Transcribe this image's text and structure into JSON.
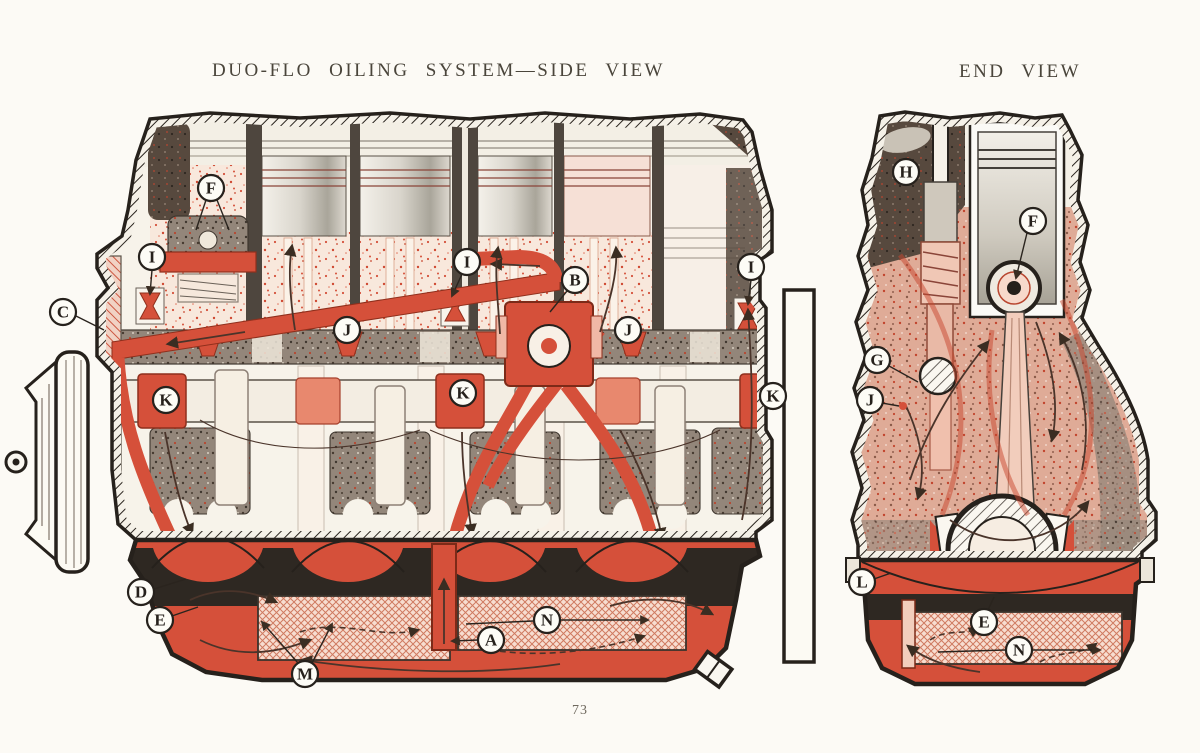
{
  "titles": {
    "side_view": "DUO-FLO OILING SYSTEM—SIDE VIEW",
    "end_view": "END VIEW"
  },
  "page_number": "73",
  "colors": {
    "paper": "#fcfaf5",
    "ink": "#26211c",
    "oil_red": "#d5503a",
    "salmon": "#e8886e",
    "pale_pink": "#f8e8dd",
    "speckle_gray": "#93867b",
    "piston_gray": "#c9c5ba"
  },
  "side_view": {
    "callouts": [
      {
        "letter": "F",
        "x": 211,
        "y": 188,
        "leaders": [
          {
            "d": "M206,200 L196,230"
          },
          {
            "d": "M217,200 L229,230"
          }
        ]
      },
      {
        "letter": "I",
        "x": 152,
        "y": 257,
        "leaders": [
          {
            "d": "M152,270 L150,294",
            "arrow": true
          }
        ]
      },
      {
        "letter": "C",
        "x": 63,
        "y": 312,
        "leaders": [
          {
            "d": "M76,316 L104,330"
          }
        ]
      },
      {
        "letter": "I",
        "x": 467,
        "y": 262,
        "leaders": [
          {
            "d": "M462,274 L452,296",
            "arrow": true
          }
        ]
      },
      {
        "letter": "B",
        "x": 575,
        "y": 280,
        "leaders": [
          {
            "d": "M567,291 L550,312"
          }
        ]
      },
      {
        "letter": "J",
        "x": 347,
        "y": 330,
        "leaders": []
      },
      {
        "letter": "J",
        "x": 628,
        "y": 330,
        "leaders": []
      },
      {
        "letter": "I",
        "x": 751,
        "y": 267,
        "leaders": [
          {
            "d": "M751,280 L748,304",
            "arrow": true
          }
        ]
      },
      {
        "letter": "K",
        "x": 166,
        "y": 400,
        "leaders": []
      },
      {
        "letter": "K",
        "x": 463,
        "y": 393,
        "leaders": []
      },
      {
        "letter": "K",
        "x": 773,
        "y": 396,
        "leaders": []
      },
      {
        "letter": "D",
        "x": 141,
        "y": 592,
        "leaders": [
          {
            "d": "M154,589 L186,579"
          }
        ]
      },
      {
        "letter": "E",
        "x": 160,
        "y": 620,
        "leaders": [
          {
            "d": "M172,616 L198,607"
          }
        ]
      },
      {
        "letter": "M",
        "x": 305,
        "y": 674,
        "leaders": [
          {
            "d": "M298,663 L262,622",
            "arrow": true
          },
          {
            "d": "M312,663 L332,624",
            "arrow": true
          }
        ]
      },
      {
        "letter": "A",
        "x": 491,
        "y": 640,
        "leaders": [
          {
            "d": "M478,640 L452,641",
            "arrow": true
          }
        ]
      },
      {
        "letter": "N",
        "x": 547,
        "y": 620,
        "leaders": [
          {
            "d": "M533,621 L466,624"
          },
          {
            "d": "M561,620 L648,620",
            "arrow": true
          }
        ]
      }
    ]
  },
  "end_view": {
    "callouts": [
      {
        "letter": "H",
        "x": 906,
        "y": 172,
        "leaders": []
      },
      {
        "letter": "F",
        "x": 1033,
        "y": 221,
        "leaders": [
          {
            "d": "M1027,233 L1016,278",
            "arrow": true
          }
        ]
      },
      {
        "letter": "G",
        "x": 877,
        "y": 360,
        "leaders": [
          {
            "d": "M889,366 L918,382"
          }
        ]
      },
      {
        "letter": "J",
        "x": 870,
        "y": 400,
        "leaders": [
          {
            "d": "M882,403 L899,406"
          }
        ]
      },
      {
        "letter": "L",
        "x": 862,
        "y": 582,
        "leaders": [
          {
            "d": "M874,579 L891,573"
          }
        ]
      },
      {
        "letter": "E",
        "x": 984,
        "y": 622,
        "leaders": [
          {
            "d": "M988,610 L994,597"
          }
        ]
      },
      {
        "letter": "N",
        "x": 1019,
        "y": 650,
        "leaders": [
          {
            "d": "M1005,650 L938,652"
          },
          {
            "d": "M1033,650 L1100,650",
            "arrow": true
          }
        ]
      }
    ]
  }
}
